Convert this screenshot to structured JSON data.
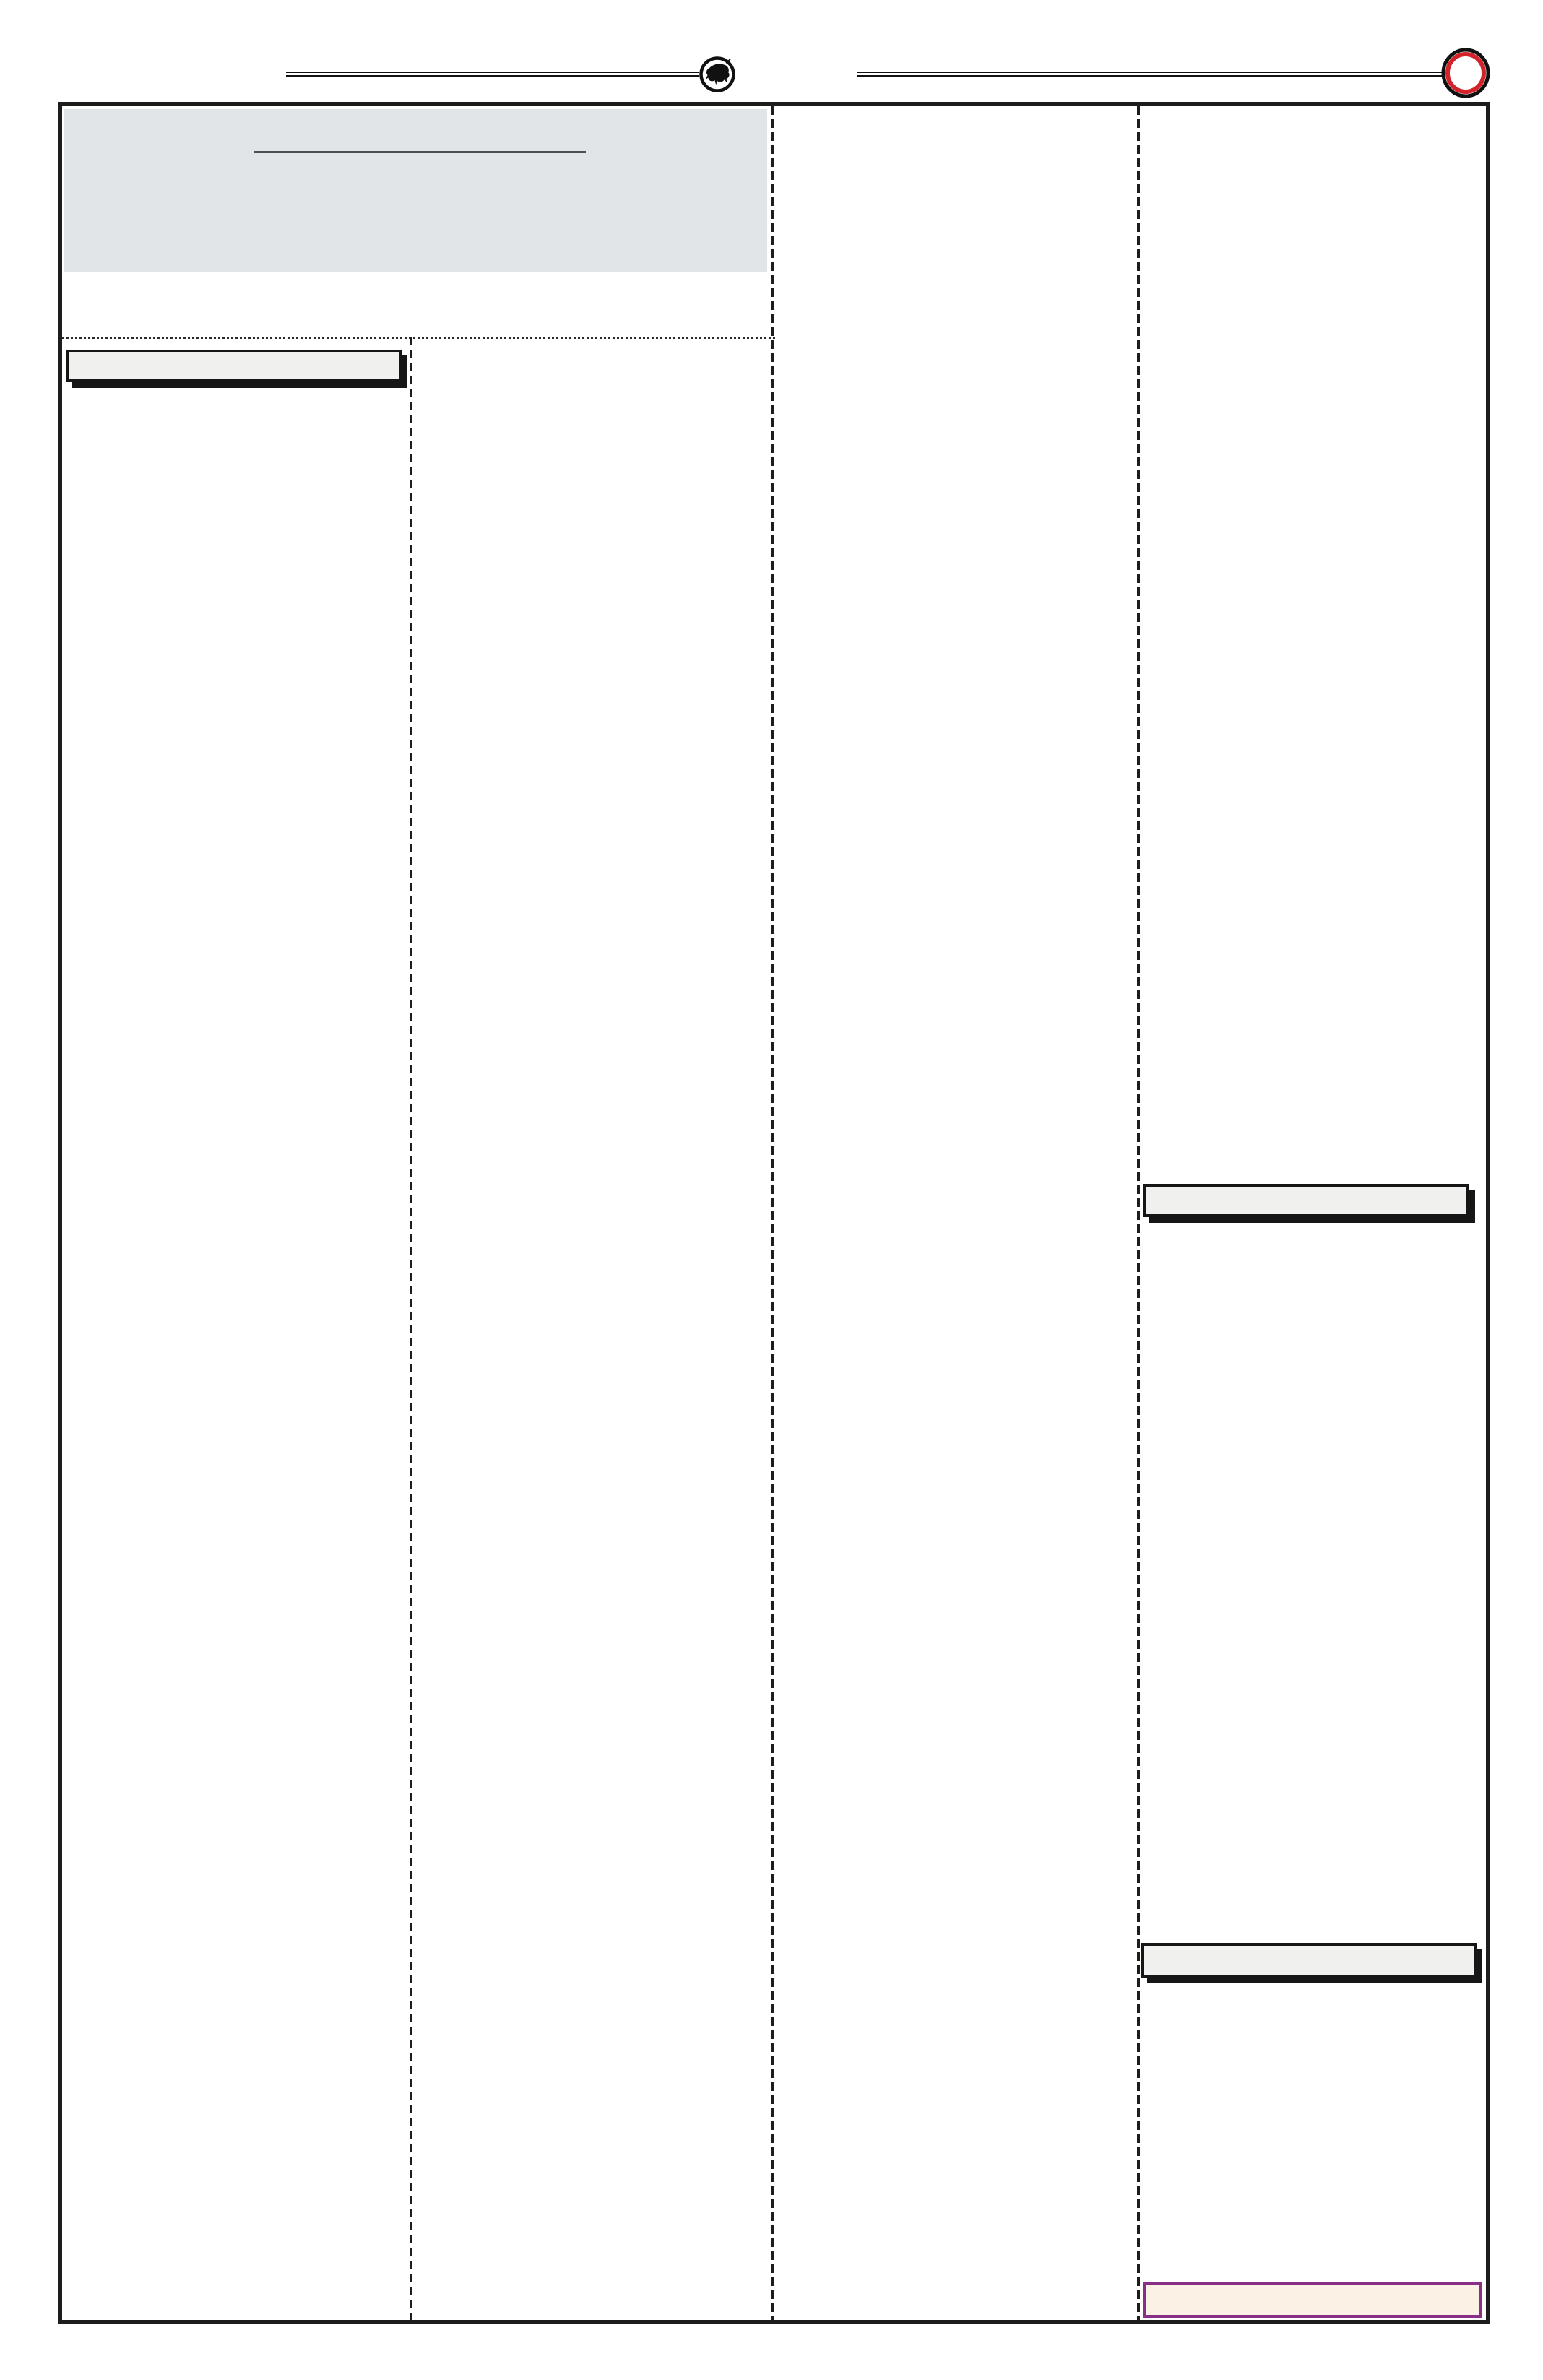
{
  "document": {
    "type": "blank-newspaper-page-template",
    "visible_text": "",
    "columns": 4
  },
  "colors": {
    "page-bg": "#ffffff",
    "frame-border": "#1d1d1b",
    "masthead-panel-bg": "#e2e5e7",
    "masthead-rule": "#4a4f55",
    "divider": "#1d1d1b",
    "dotted-rule": "#2a2a2a",
    "bar-bg": "#f0f0ee",
    "bar-border": "#161616",
    "bar-shadow": "#161616",
    "highlight-bar-bg": "#fcf1e5",
    "highlight-bar-border": "#8a2f86",
    "seal-ring-red": "#d2232a",
    "seal-ink": "#111111",
    "top-rule": "#111111"
  },
  "icons": {
    "left_seal": "bull-emblem-icon",
    "right_seal": "red-ring-seal-icon"
  }
}
